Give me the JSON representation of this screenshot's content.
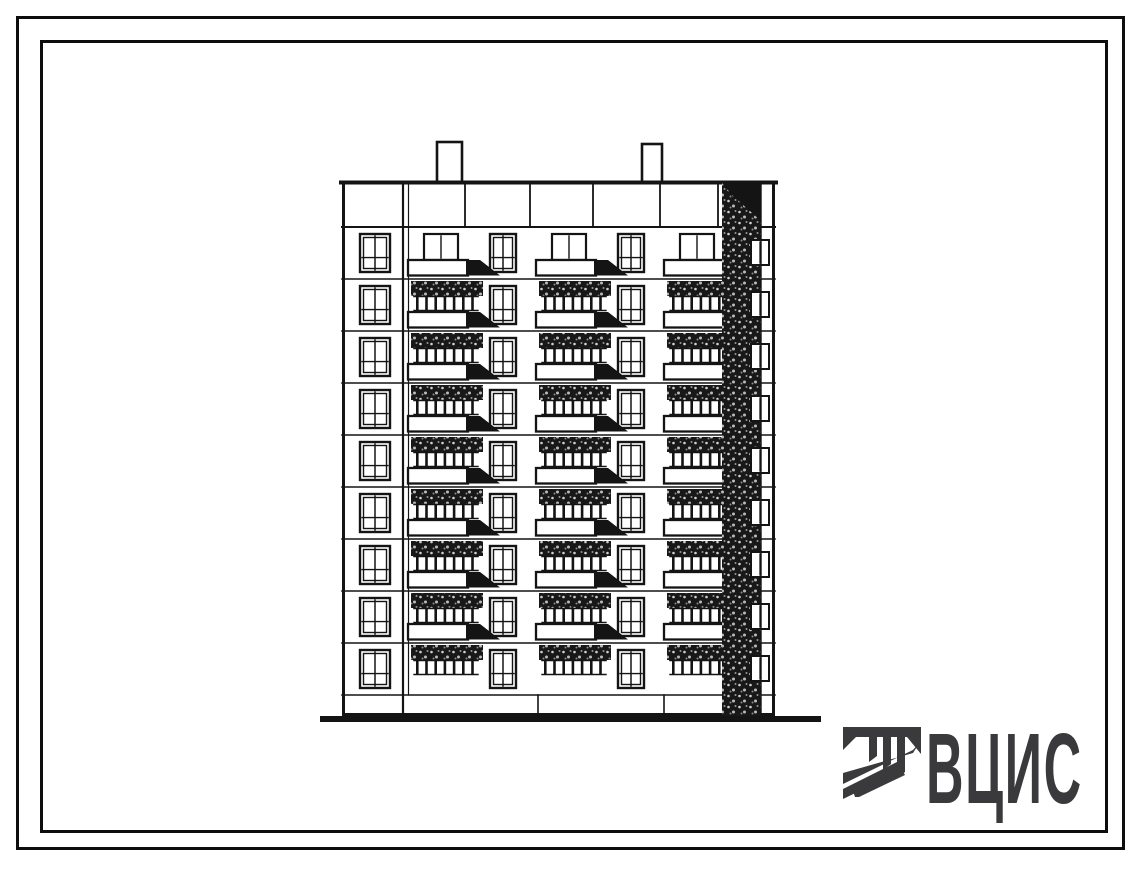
{
  "page": {
    "kind": "scanned typical-project catalogue sheet",
    "paper_color": "#ffffff",
    "frame_color": "#0d0d0d"
  },
  "drawing": {
    "subject": "nine-storey large-panel apartment block, end elevation with balconies",
    "floors": 9,
    "balcony_stacks": 3,
    "stair_window_column": 1,
    "chimneys": 2,
    "ink_color": "#141414"
  },
  "logo": {
    "text": "ВЦИС",
    "color": "#3a3a3d",
    "icon": "striped-column-icon"
  }
}
